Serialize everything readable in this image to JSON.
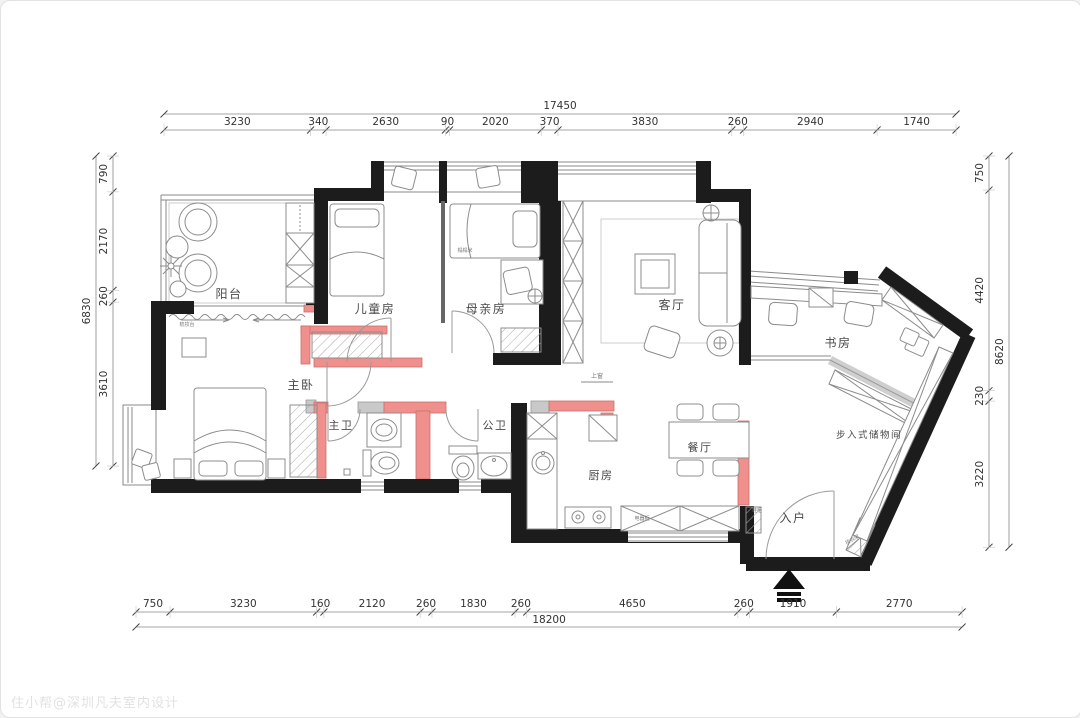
{
  "watermark": "住小帮@深圳凡夫室内设计",
  "colors": {
    "wall": "#1c1c1c",
    "new_wall": "#f0908d",
    "new_wall_border": "#c9706c",
    "masonry_gray": "#c9c9c9",
    "furniture_line": "#8c8c8c",
    "dim_text": "#333333",
    "label_text": "#4a4a4a",
    "tiny_text": "#777777"
  },
  "dimensions": {
    "top": {
      "total": "17450",
      "segments": [
        "3230",
        "340",
        "2630",
        "90",
        "2020",
        "370",
        "3830",
        "260",
        "2940",
        "1740"
      ]
    },
    "bottom": {
      "total": "18200",
      "segments": [
        "750",
        "3230",
        "160",
        "2120",
        "260",
        "1830",
        "260",
        "4650",
        "260",
        "1910",
        "2770"
      ]
    },
    "left": {
      "total": "6830",
      "segments": [
        "790",
        "2170",
        "260",
        "3610"
      ]
    },
    "right": {
      "total": "8620",
      "segments": [
        "750",
        "4420",
        "230",
        "3220"
      ]
    }
  },
  "rooms": [
    {
      "id": "balcony",
      "label": "阳台",
      "x": 228,
      "y": 297,
      "size": 12
    },
    {
      "id": "kids-room",
      "label": "儿童房",
      "x": 374,
      "y": 312,
      "size": 12
    },
    {
      "id": "mother-room",
      "label": "母亲房",
      "x": 485,
      "y": 312,
      "size": 12
    },
    {
      "id": "living-room",
      "label": "客厅",
      "x": 671,
      "y": 308,
      "size": 12
    },
    {
      "id": "study",
      "label": "书房",
      "x": 837,
      "y": 346,
      "size": 12
    },
    {
      "id": "master-bedroom",
      "label": "主卧",
      "x": 300,
      "y": 388,
      "size": 12
    },
    {
      "id": "master-bath",
      "label": "主卫",
      "x": 340,
      "y": 428,
      "size": 11
    },
    {
      "id": "public-bath",
      "label": "公卫",
      "x": 494,
      "y": 428,
      "size": 11
    },
    {
      "id": "kitchen",
      "label": "厨房",
      "x": 600,
      "y": 478,
      "size": 11
    },
    {
      "id": "dining",
      "label": "餐厅",
      "x": 699,
      "y": 450,
      "size": 11
    },
    {
      "id": "entry",
      "label": "入户",
      "x": 792,
      "y": 521,
      "size": 12
    },
    {
      "id": "walkin-storage",
      "label": "步入式储物间",
      "x": 868,
      "y": 437,
      "size": 9.5
    }
  ],
  "small_labels": [
    {
      "id": "tatami",
      "text": "榻榻米",
      "x": 464,
      "y": 251,
      "size": 5,
      "rotate": 0
    },
    {
      "id": "dressing-table",
      "text": "梳妆台",
      "x": 186,
      "y": 325,
      "size": 5,
      "rotate": 0
    },
    {
      "id": "appliance-cabinet",
      "text": "电器柜",
      "x": 641,
      "y": 519,
      "size": 5,
      "rotate": 0
    },
    {
      "id": "shoe-cabinet",
      "text": "鞋柜",
      "x": 756,
      "y": 511,
      "size": 5,
      "rotate": 0
    },
    {
      "id": "coat-rack",
      "text": "挂衣架",
      "x": 852,
      "y": 540,
      "size": 5,
      "rotate": -30
    },
    {
      "id": "window-above",
      "text": "上窗",
      "x": 596,
      "y": 377,
      "size": 6,
      "rotate": 0
    }
  ]
}
